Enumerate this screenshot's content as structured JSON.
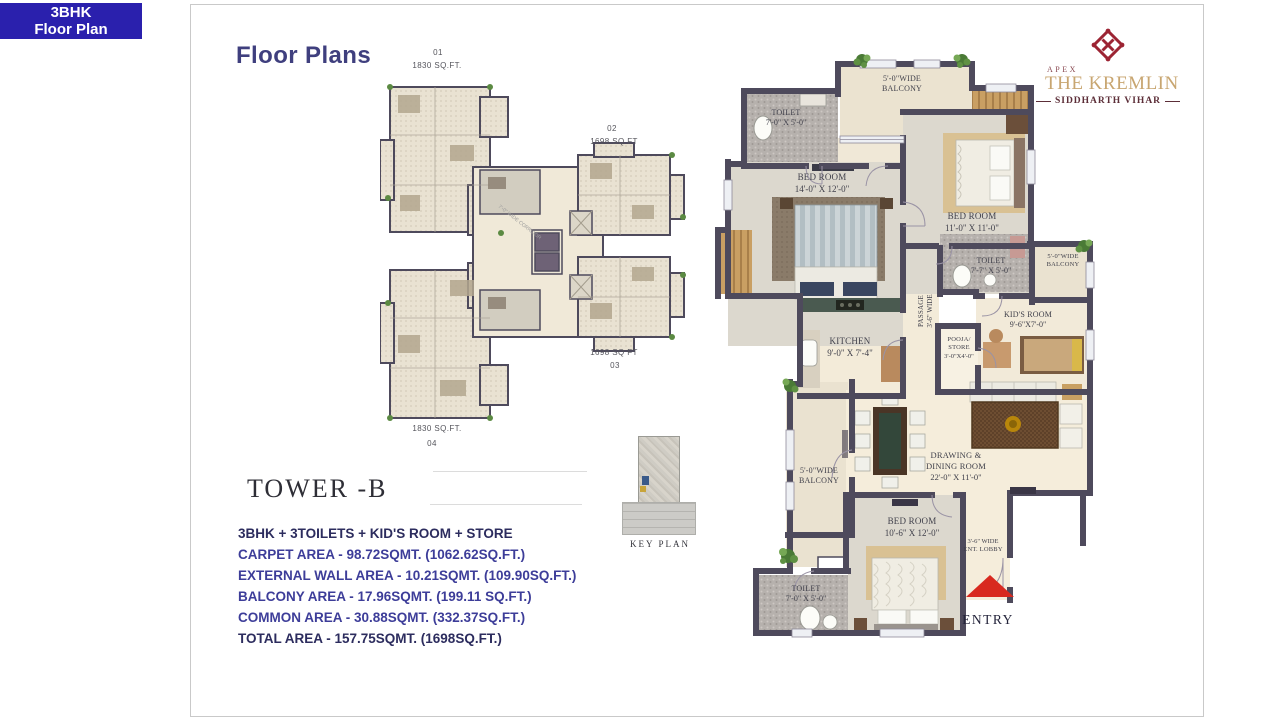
{
  "badge": {
    "line1": "3BHK",
    "line2": "Floor Plan"
  },
  "page": {
    "title": "Floor Plans"
  },
  "brand": {
    "apex": "APEX",
    "name": "THE KREMLIN",
    "location": "SIDDHARTH VIHAR",
    "monogram_color": "#9c2433",
    "gold": "#c8a671"
  },
  "tower_plan": {
    "units": [
      {
        "id": "01",
        "area": "1830 SQ.FT."
      },
      {
        "id": "02",
        "area": "1698 SQ FT"
      },
      {
        "id": "03",
        "area": "1698 SQ FT"
      },
      {
        "id": "04",
        "area": "1830 SQ.FT."
      }
    ]
  },
  "key_plan": {
    "label": "KEY PLAN"
  },
  "tower_info": {
    "tower": "TOWER -B",
    "config": "3BHK + 3TOILETS + KID'S ROOM + STORE",
    "areas": [
      {
        "text": "CARPET AREA - 98.72SQMT.  (1062.62SQ.FT.)"
      },
      {
        "text": "EXTERNAL WALL AREA - 10.21SQMT. (109.90SQ.FT.)"
      },
      {
        "text": "BALCONY AREA - 17.96SQMT. (199.11  SQ.FT.)"
      },
      {
        "text": "COMMON AREA - 30.88SQMT. (332.37SQ.FT.)"
      },
      {
        "text": "TOTAL AREA - 157.75SQMT. (1698SQ.FT.)"
      }
    ]
  },
  "unit_plan": {
    "rooms": {
      "toilet_top": {
        "l1": "TOILET",
        "l2": "7'-0\" X 5'-0\""
      },
      "balcony_top": {
        "l1": "5'-0\"WIDE",
        "l2": "BALCONY"
      },
      "bedroom_master": {
        "l1": "BED ROOM",
        "l2": "14'-0\" X 12'-0\""
      },
      "bedroom_right": {
        "l1": "BED ROOM",
        "l2": "11'-0\" X 11'-0\""
      },
      "toilet_right": {
        "l1": "TOILET",
        "l2": "7'-7\" X 5'-0\""
      },
      "balcony_right": {
        "l1": "5'-0\"WIDE",
        "l2": "BALCONY"
      },
      "kids_room": {
        "l1": "KID'S ROOM",
        "l2": "9'-6\"X7'-0\""
      },
      "pooja": {
        "l1": "POOJA/",
        "l2": "STORE",
        "l3": "3'-0\"X4'-0\""
      },
      "kitchen": {
        "l1": "KITCHEN",
        "l2": "9'-0\" X 7'-4\""
      },
      "passage": {
        "l1": "PASSAGE",
        "l2": "3'-6\" WIDE"
      },
      "balcony_left": {
        "l1": "5'-0\"WIDE",
        "l2": "BALCONY"
      },
      "drawing_dining": {
        "l1": "DRAWING &",
        "l2": "DINING ROOM",
        "l3": "22'-0\" X 11'-0\""
      },
      "bedroom_bottom": {
        "l1": "BED ROOM",
        "l2": "10'-6\" X 12'-0\""
      },
      "toilet_bottom": {
        "l1": "TOILET",
        "l2": "7'-0\" X 5'-0\""
      },
      "lobby": {
        "l1": "3'-6\" WIDE",
        "l2": "ENT. LOBBY"
      }
    },
    "entry_label": "ENTRY",
    "entry_color": "#d8291f",
    "wall_color": "#4e4a5c"
  }
}
